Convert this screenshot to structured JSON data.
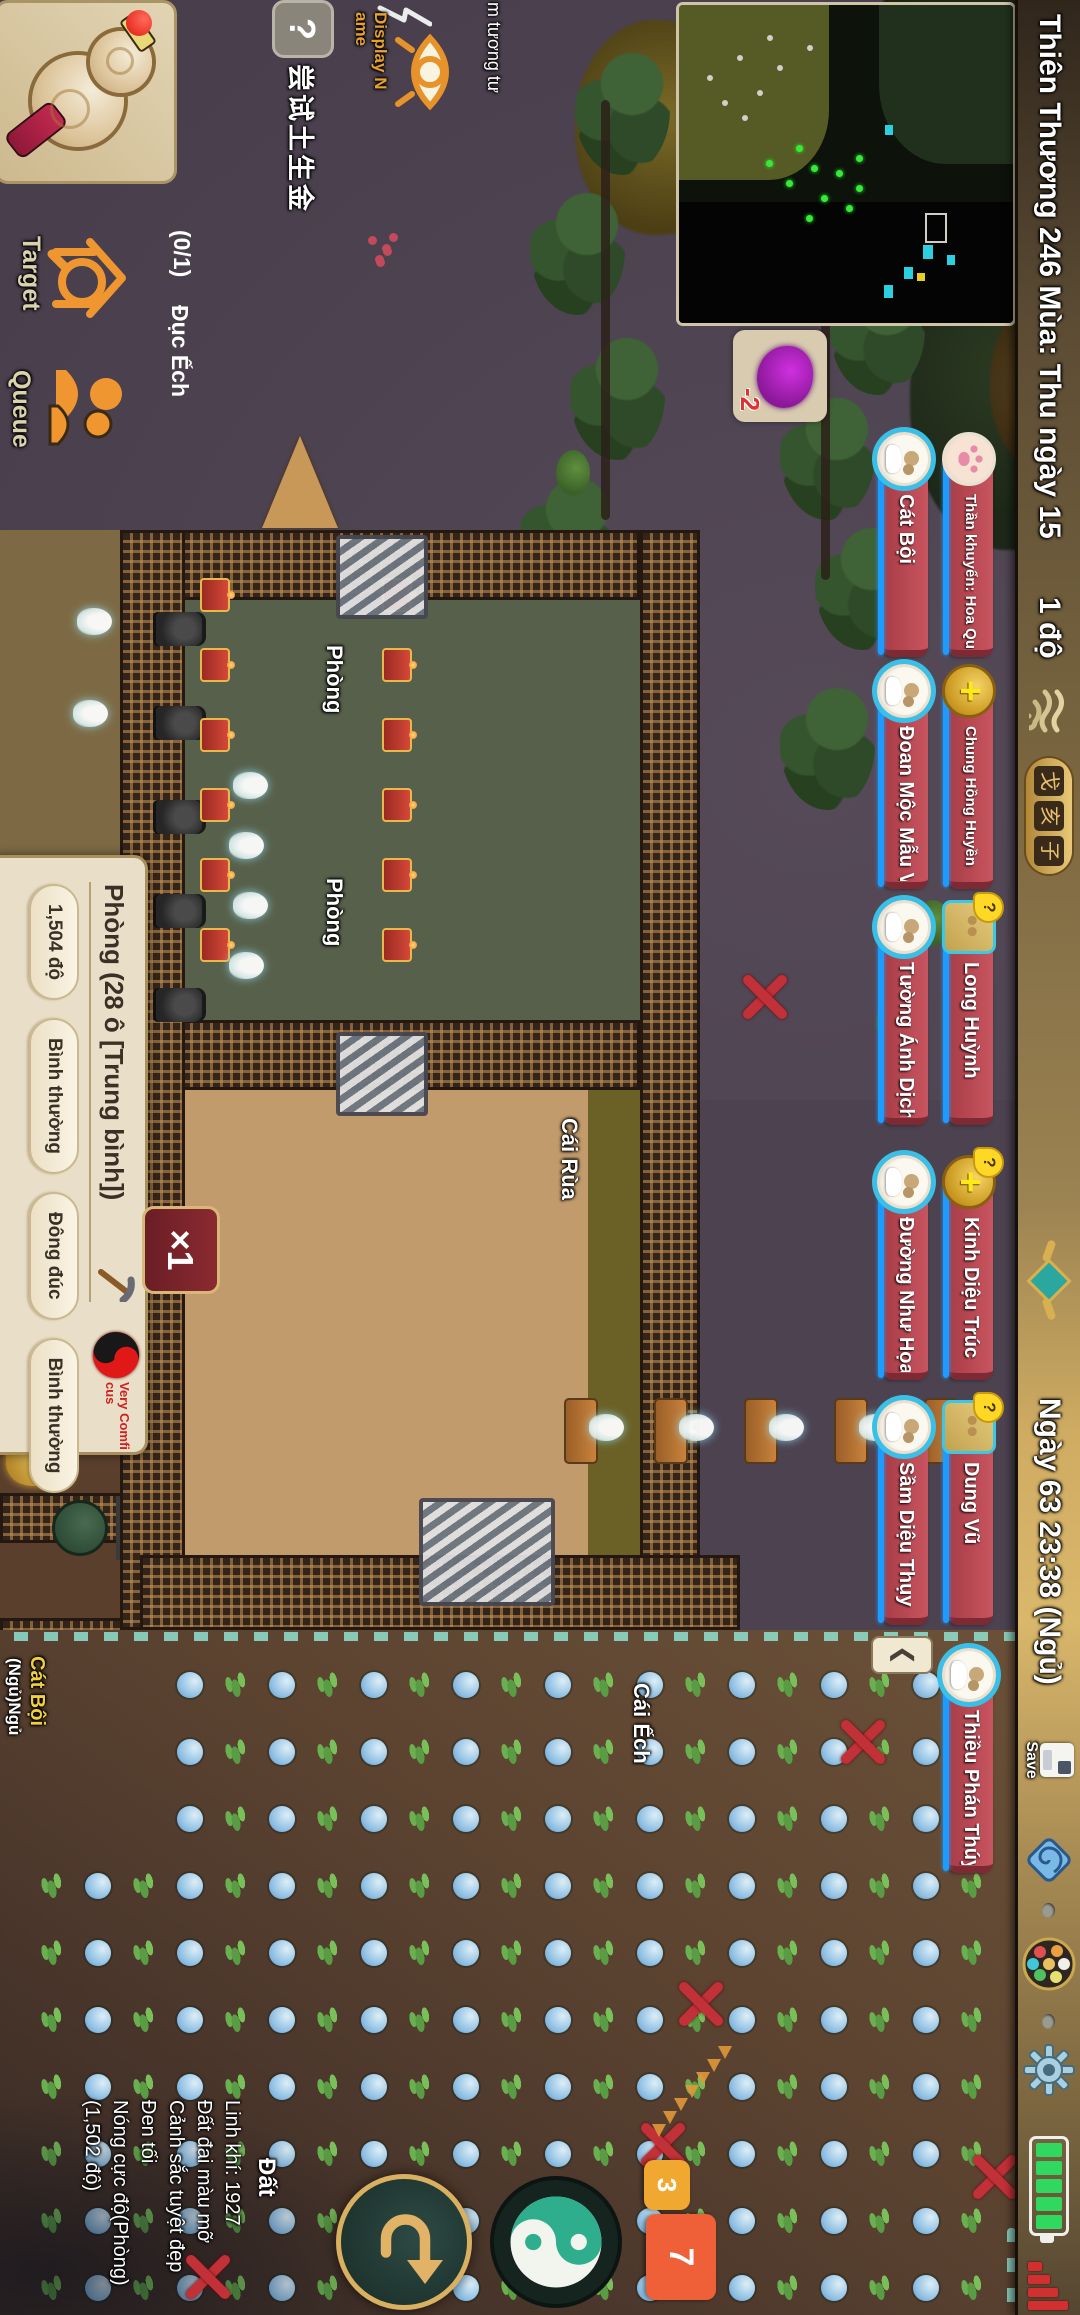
{
  "top_bar": {
    "season_text": "Thiên Thương 246 Mùa: Thu ngày 15",
    "temperature": "1 độ",
    "day_text": "Ngày 63 23:38 (Ngủ)",
    "save_label": "Save",
    "seal_chars": [
      "戈",
      "亥",
      "子"
    ],
    "accent_gold": "#cfac62"
  },
  "characters": {
    "row1": [
      {
        "name": "Thần khuyển: Hoa Quyển",
        "icon": "paw",
        "question": false
      },
      {
        "name": "Chung Hồng Huyền",
        "icon": "coin-plus",
        "question": false
      },
      {
        "name": "Long Huỳnh",
        "icon": "square-portrait",
        "question": true
      },
      {
        "name": "Kinh Diệu Trúc",
        "icon": "coin-plus",
        "question": true
      },
      {
        "name": "Dung Vũ",
        "icon": "square-portrait",
        "question": true
      },
      {
        "name": "Thiều Phán Thúy",
        "icon": "circle-portrait",
        "question": false
      }
    ],
    "row2": [
      {
        "name": "Cát Bội",
        "icon": "circle-portrait",
        "question": false
      },
      {
        "name": "Đoan Mộc Mẫu Vi",
        "icon": "circle-portrait",
        "question": false
      },
      {
        "name": "Tường Ánh Dịch",
        "icon": "circle-portrait",
        "question": false
      },
      {
        "name": "Đường Như Họa",
        "icon": "circle-portrait",
        "question": false
      },
      {
        "name": "Sầm Diệu Thụy",
        "icon": "circle-portrait",
        "question": false
      }
    ],
    "collapse_label": "❮",
    "coin_plus": "+",
    "question_mark": "?",
    "plate_red": "#b9474f",
    "bar_blue": "#1e9bff"
  },
  "left_hud": {
    "help_label": "?",
    "hint_text": "尝试土生金",
    "display_name_lines": [
      "Display N",
      "ame"
    ],
    "plant_label": "m tương tư",
    "target_label": "Target",
    "queue_label": "Queue",
    "task_progress": "(0/1)",
    "task_name": "Đục Ếch"
  },
  "room_panel": {
    "title": "Phòng (28 ô [Trung bình])",
    "pills": [
      "1,504 độ",
      "Bình thường",
      "Đông đúc",
      "Bình thường"
    ],
    "mood_lines": [
      "Very Comfi",
      "cus"
    ]
  },
  "tile_tooltip": {
    "title": "Đất",
    "lines": [
      "Linh khí: 1927",
      "Đất đai màu mỡ",
      "Cảnh sắc tuyệt đẹp",
      "Đen tối",
      "Nóng cực độ(Phòng)",
      "(1,502 độ)"
    ]
  },
  "world_labels": {
    "room1": "Phòng",
    "room2": "Phòng",
    "turtle_pet": "Cái Rùa",
    "frog_pet": "Cái Ếch",
    "sleeper_name": "Cát Bội",
    "sleeper_status": "(Ngủ)Ngủ",
    "turtle_debuff": "-2"
  },
  "controls": {
    "speed_label": "×1",
    "badge_small": "3",
    "badge_large": "7"
  }
}
